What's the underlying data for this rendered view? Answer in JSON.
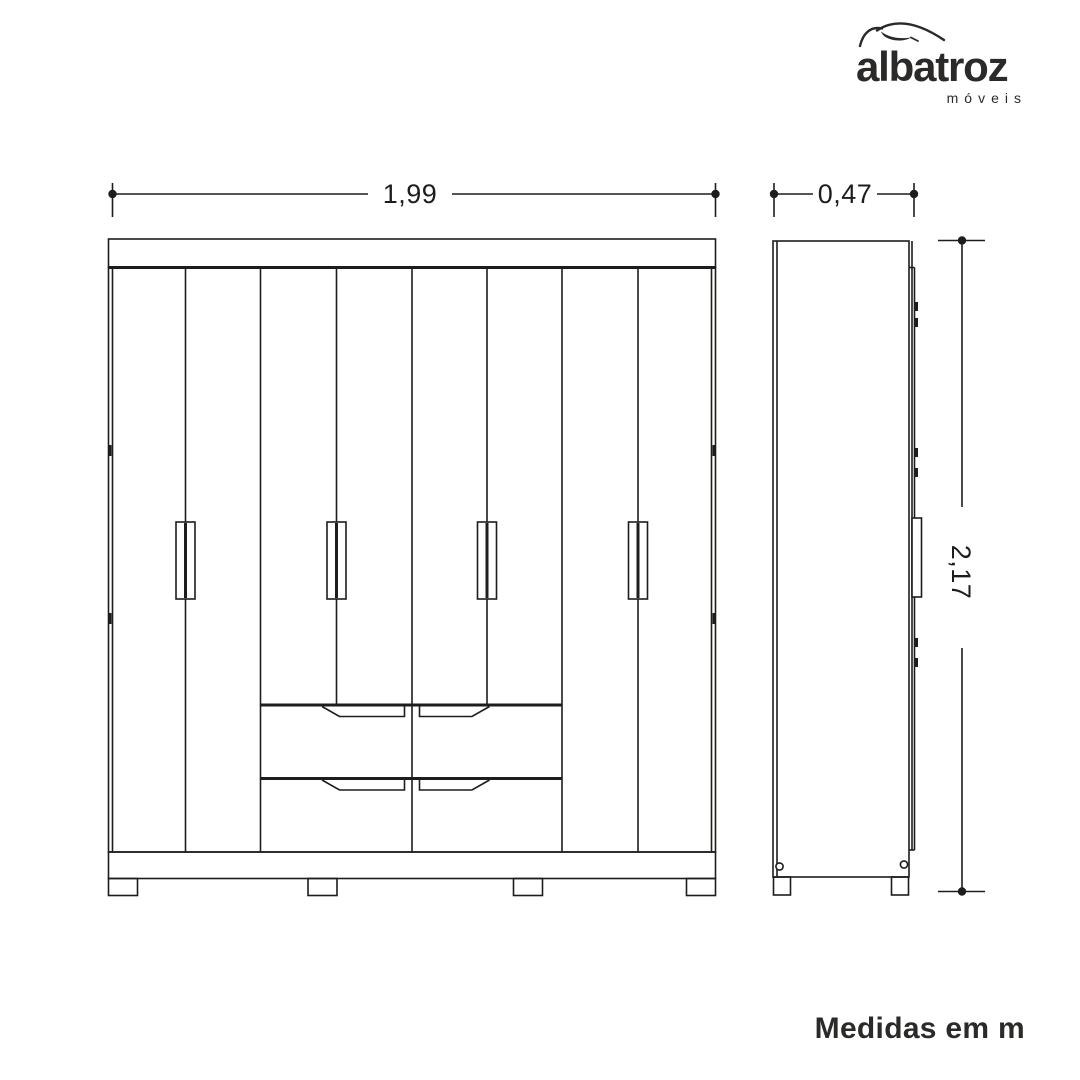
{
  "colors": {
    "background": "#ffffff",
    "ink": "#1d1d1b",
    "text": "#2b2a29"
  },
  "logo": {
    "brand": "albatroz",
    "subtitle": "móveis",
    "icon": "albatross-swoosh"
  },
  "dimensions": {
    "width_m": "1,99",
    "depth_m": "0,47",
    "height_m": "2,17",
    "units_note": "Medidas em m"
  },
  "drawing": {
    "type": "furniture-technical-drawing",
    "subject": "wardrobe",
    "views": [
      {
        "name": "front",
        "door_panels": 8,
        "handles": 4,
        "drawers": 4,
        "feet": 4
      },
      {
        "name": "side",
        "hinge_marks": 6,
        "feet": 2,
        "glides": 2
      }
    ]
  }
}
